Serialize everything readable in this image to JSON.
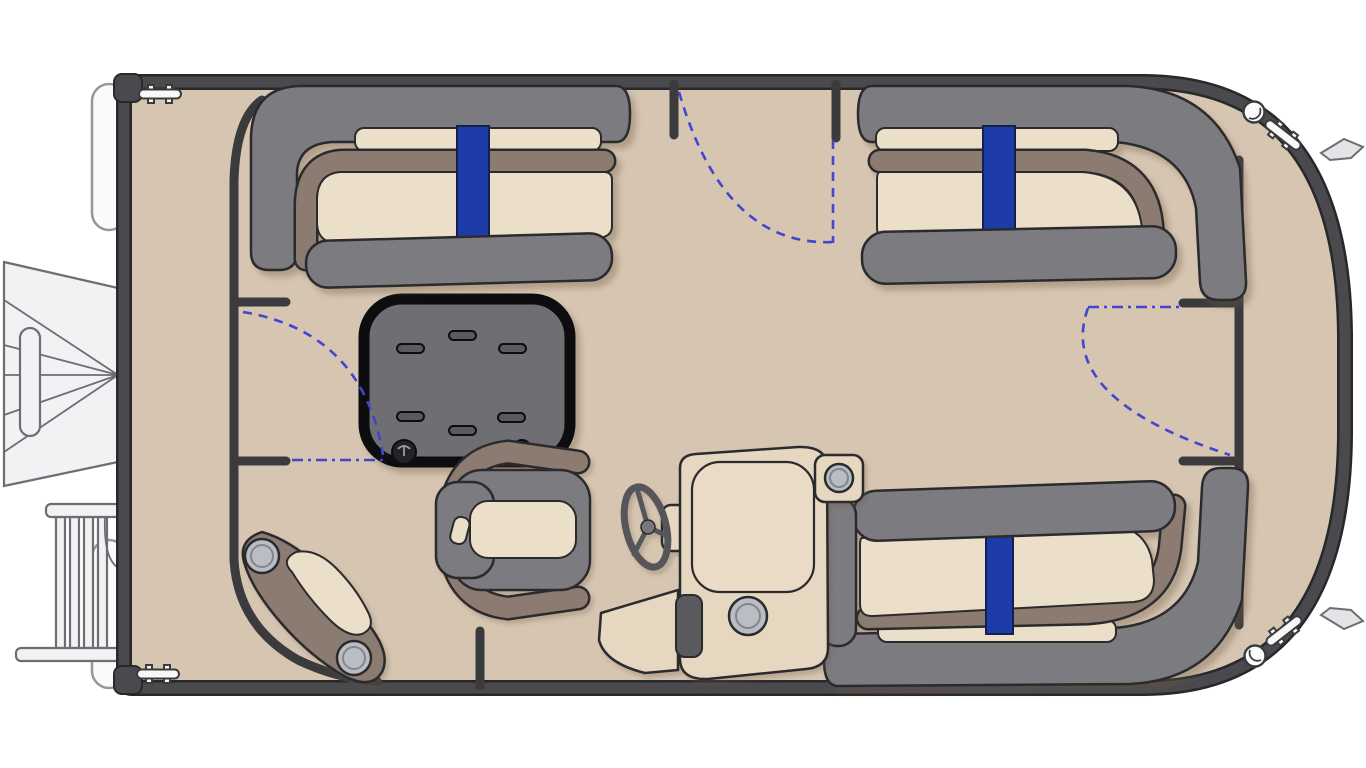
{
  "diagram": {
    "title": "Pontoon boat floor plan (top view, bow at right)",
    "components": [
      {
        "id": "hull",
        "label": "Pontoon deck with hull rail"
      },
      {
        "id": "aft-port-lounge",
        "label": "Aft port L-lounge seat with blue accent stripe"
      },
      {
        "id": "bow-port-lounge",
        "label": "Bow port L-lounge seat with blue accent stripe"
      },
      {
        "id": "bow-starboard-lounge",
        "label": "Bow starboard L-lounge seat with blue accent stripe"
      },
      {
        "id": "table",
        "label": "Center storage table with grab slots and deck anchors"
      },
      {
        "id": "helm-console",
        "label": "Helm console with windscreen, speakers and foot step"
      },
      {
        "id": "steering-wheel",
        "label": "Steering wheel"
      },
      {
        "id": "captain-chair",
        "label": "Captain's chair with headrest and wrap armrest"
      },
      {
        "id": "corner-pod",
        "label": "Aft starboard corner step pod with two speakers"
      },
      {
        "id": "port-gate",
        "label": "Port side gate with swing arc"
      },
      {
        "id": "bow-gate",
        "label": "Bow side gate with swing arc"
      },
      {
        "id": "stern-gate",
        "label": "Stern side gate with swing arc"
      },
      {
        "id": "starboard-gate-opening",
        "label": "Starboard gate opening by helm"
      },
      {
        "id": "outboard-motor",
        "label": "Outboard motor (stern)"
      },
      {
        "id": "boarding-ladder",
        "label": "Boarding ladder (stern)"
      },
      {
        "id": "pontoon-tubes",
        "label": "Pontoon tube stern tips (2)"
      },
      {
        "id": "cleats",
        "label": "Mooring cleats (4)"
      },
      {
        "id": "nav-lights",
        "label": "Deck lights (2)"
      },
      {
        "id": "bow-fins",
        "label": "Bow hull fittings (2)"
      }
    ]
  },
  "palette": {
    "bg": "#ffffff",
    "deck": "#d6c5b1",
    "hull": "#4a4a4e",
    "hull_edge": "#28282b",
    "fence": "#3b3b3e",
    "ink": "#2b2b2e",
    "seat": "#7c7c80",
    "cushion": "#ebdfc9",
    "trim": "#8b7b71",
    "blue": "#1e3ca8",
    "blue_dark": "#13204e",
    "table": "#6f6f73",
    "table_edge": "#0d0d0f",
    "slot": "#5a5a5f",
    "gate": "#4245cf",
    "fitting": "#f8f8f8",
    "paper": "#f2f2f4",
    "line_ink": "#6e6e72",
    "speaker": "#b9bdc4",
    "tan": "#e6d7c1",
    "tan_light": "#e9dbc5",
    "wheel": "#55555a"
  }
}
